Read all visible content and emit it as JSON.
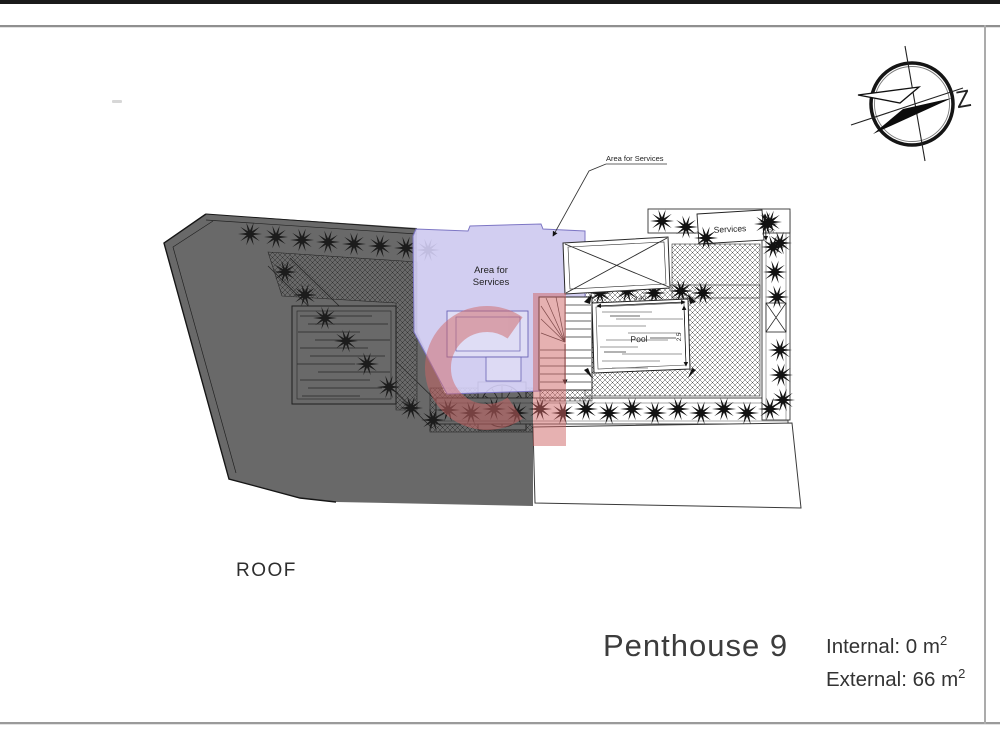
{
  "compass": {
    "label": "Z"
  },
  "plan": {
    "leader_label": "Area for Services",
    "area_for_services": {
      "line1": "Area for",
      "line2": "Services"
    },
    "services_label": "Services",
    "pool_label": "Pool",
    "dimensions": {
      "pool_width": "4.40",
      "pool_height": "2.5",
      "services_height": "0.77"
    }
  },
  "footer": {
    "floor_label": "ROOF",
    "unit_name": "Penthouse 9",
    "internal": {
      "text": "Internal: 0 m",
      "sup": "2"
    },
    "external": {
      "text": "External: 66 m",
      "sup": "2"
    }
  },
  "colors": {
    "area_service_fill": "#cfcaf0",
    "area_service_border": "#7d76c4",
    "watermark_red": "#cf6565",
    "roof_overlay_gray": "#696969",
    "line_dark": "#222222"
  }
}
